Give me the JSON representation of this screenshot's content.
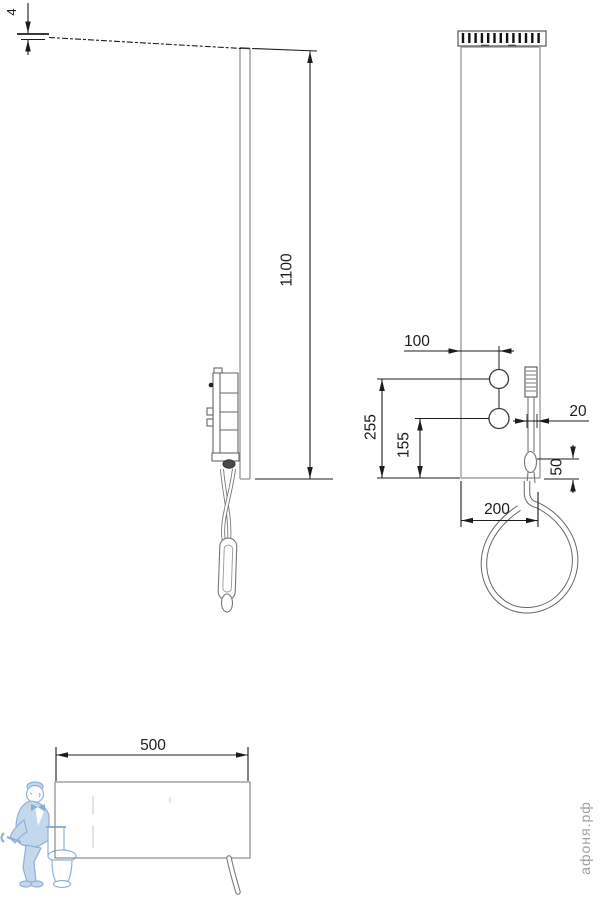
{
  "drawing": {
    "type": "technical-drawing",
    "subject": "shower panel with hand shower — side view, front view, plan view",
    "views": {
      "side_view": "left",
      "front_view": "right",
      "plan_view": "bottom-left"
    },
    "dimensions": {
      "top_thickness": "4",
      "height": "1100",
      "knob_offset": "100",
      "upper_knob_from_bottom": "255",
      "lower_knob_from_bottom": "155",
      "handshower_width": "20",
      "holder_from_bottom": "50",
      "width": "200",
      "depth": "500"
    },
    "watermark": {
      "text": "афоня.рф",
      "color": "#9f9f9f"
    },
    "colors": {
      "dimension_lines": "#1c1c1c",
      "panel_lines": "#8e8e8e",
      "fixture_lines": "#666666",
      "mascot_line": "#8fb1d4",
      "mascot_fill": "#c3d8ed",
      "background": "#ffffff"
    }
  }
}
